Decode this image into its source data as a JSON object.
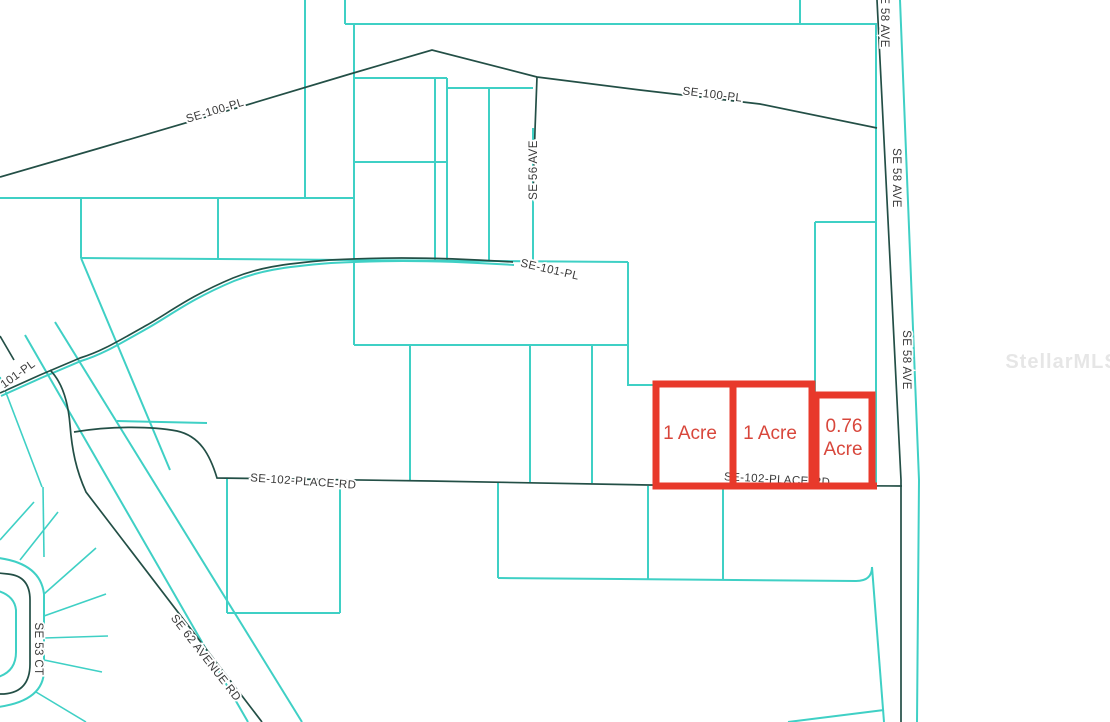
{
  "map": {
    "watermark": "StellarMLS",
    "colors": {
      "parcel_line": "#3fd0c5",
      "road_line": "#234f46",
      "highlight_outline": "#e8392b",
      "highlight_text": "#d8473c",
      "label_text": "#3a3a3a"
    },
    "road_labels": [
      {
        "id": "se-100-pl-west",
        "text": "SE-100-PL"
      },
      {
        "id": "se-100-pl-east",
        "text": "SE-100-PL"
      },
      {
        "id": "se-56-ave",
        "text": "SE 56 AVE"
      },
      {
        "id": "se-58-ave-top",
        "text": "SE 58 AVE"
      },
      {
        "id": "se-58-ave-mid",
        "text": "SE 58 AVE"
      },
      {
        "id": "se-58-ave-lower",
        "text": "SE 58 AVE"
      },
      {
        "id": "se-101-pl",
        "text": "SE-101-PL"
      },
      {
        "id": "se-101-pl-west-partial",
        "text": "101-PL"
      },
      {
        "id": "se-102-place-rd-west",
        "text": "SE-102-PLACE-RD"
      },
      {
        "id": "se-102-place-rd-east",
        "text": "SE-102-PLACE-RD"
      },
      {
        "id": "se-62-avenue-rd",
        "text": "SE 62 AVENUE RD"
      },
      {
        "id": "se-53-ct",
        "text": "SE 53 CT"
      }
    ],
    "highlighted_parcels": [
      {
        "id": "parcel-west",
        "label": "1 Acre"
      },
      {
        "id": "parcel-middle",
        "label": "1 Acre"
      },
      {
        "id": "parcel-east",
        "label": "0.76 Acre",
        "line1": "0.76",
        "line2": "Acre"
      }
    ]
  }
}
